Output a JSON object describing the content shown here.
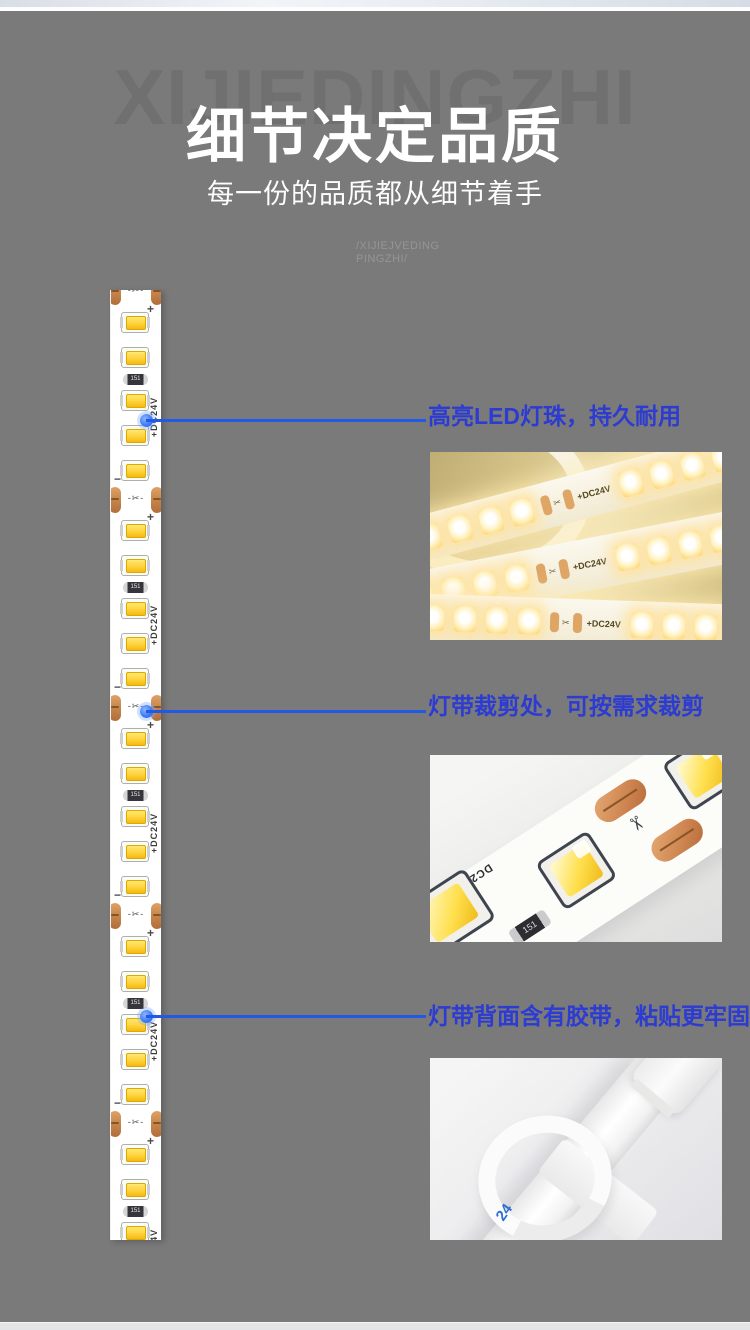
{
  "header": {
    "watermark": "XIJIEDINGZHI",
    "title": "细节决定品质",
    "subtitle": "每一份的品质都从细节着手",
    "slogan_line1": "/XIJIEJVEDING",
    "slogan_line2": "PINGZHI/"
  },
  "strip": {
    "segment_count": 5,
    "dc24v_label": "+DC24V",
    "plus_mark": "+",
    "minus_mark": "−",
    "scissors_icon": "✂",
    "resistor_label": "151"
  },
  "callouts": [
    {
      "title": "高亮LED灯珠，持久耐用"
    },
    {
      "title": "灯带裁剪处，可按需求裁剪"
    },
    {
      "title": "灯带背面含有胶带，粘贴更牢固"
    }
  ],
  "photos": {
    "lit_strip_label": "+DC24V",
    "cut_strip_label": "DC24V+",
    "cut_strip_resistor": "151",
    "scissors_icon": "✂",
    "adhesive_label": "24"
  },
  "colors": {
    "background": "#7a7a7a",
    "accent_blue_text": "#2c3bd1",
    "accent_blue_line": "#2158e6",
    "led_yellow": "#ffd23a",
    "copper_pad": "#c98750"
  }
}
